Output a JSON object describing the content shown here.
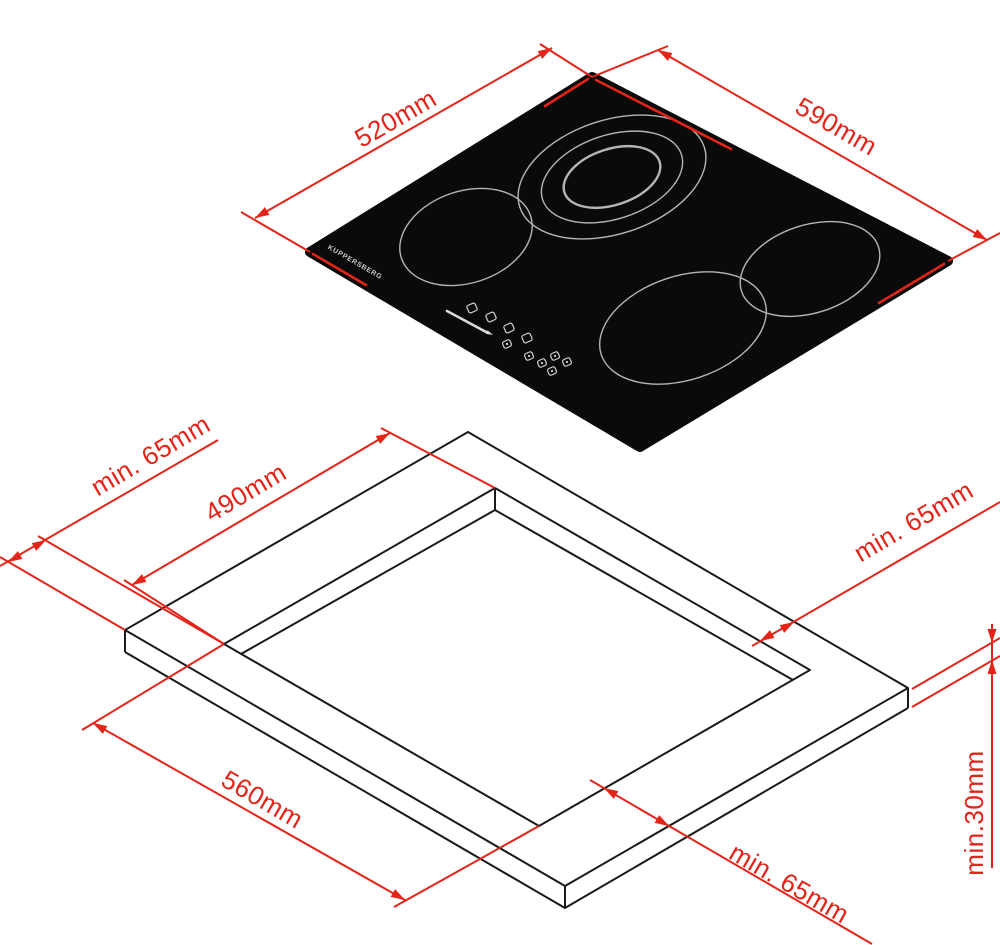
{
  "drawing": {
    "type": "hob installation dimensions diagram",
    "brand": "KUPPERSBERG",
    "hob": {
      "depth_label": "520mm",
      "width_label": "590mm"
    },
    "worktop": {
      "cutout_depth_label": "490mm",
      "cutout_width_label": "560mm",
      "clearance_left_label": "min. 65mm",
      "clearance_right_label": "min. 65mm",
      "clearance_front_label": "min. 65mm",
      "thickness_label": "min.30mm"
    },
    "colors": {
      "dimension_red": "#e42418",
      "outline_black": "#1a1a1a",
      "hob_black": "#0a0a0a",
      "ring_gray": "#b2b6b8"
    }
  }
}
